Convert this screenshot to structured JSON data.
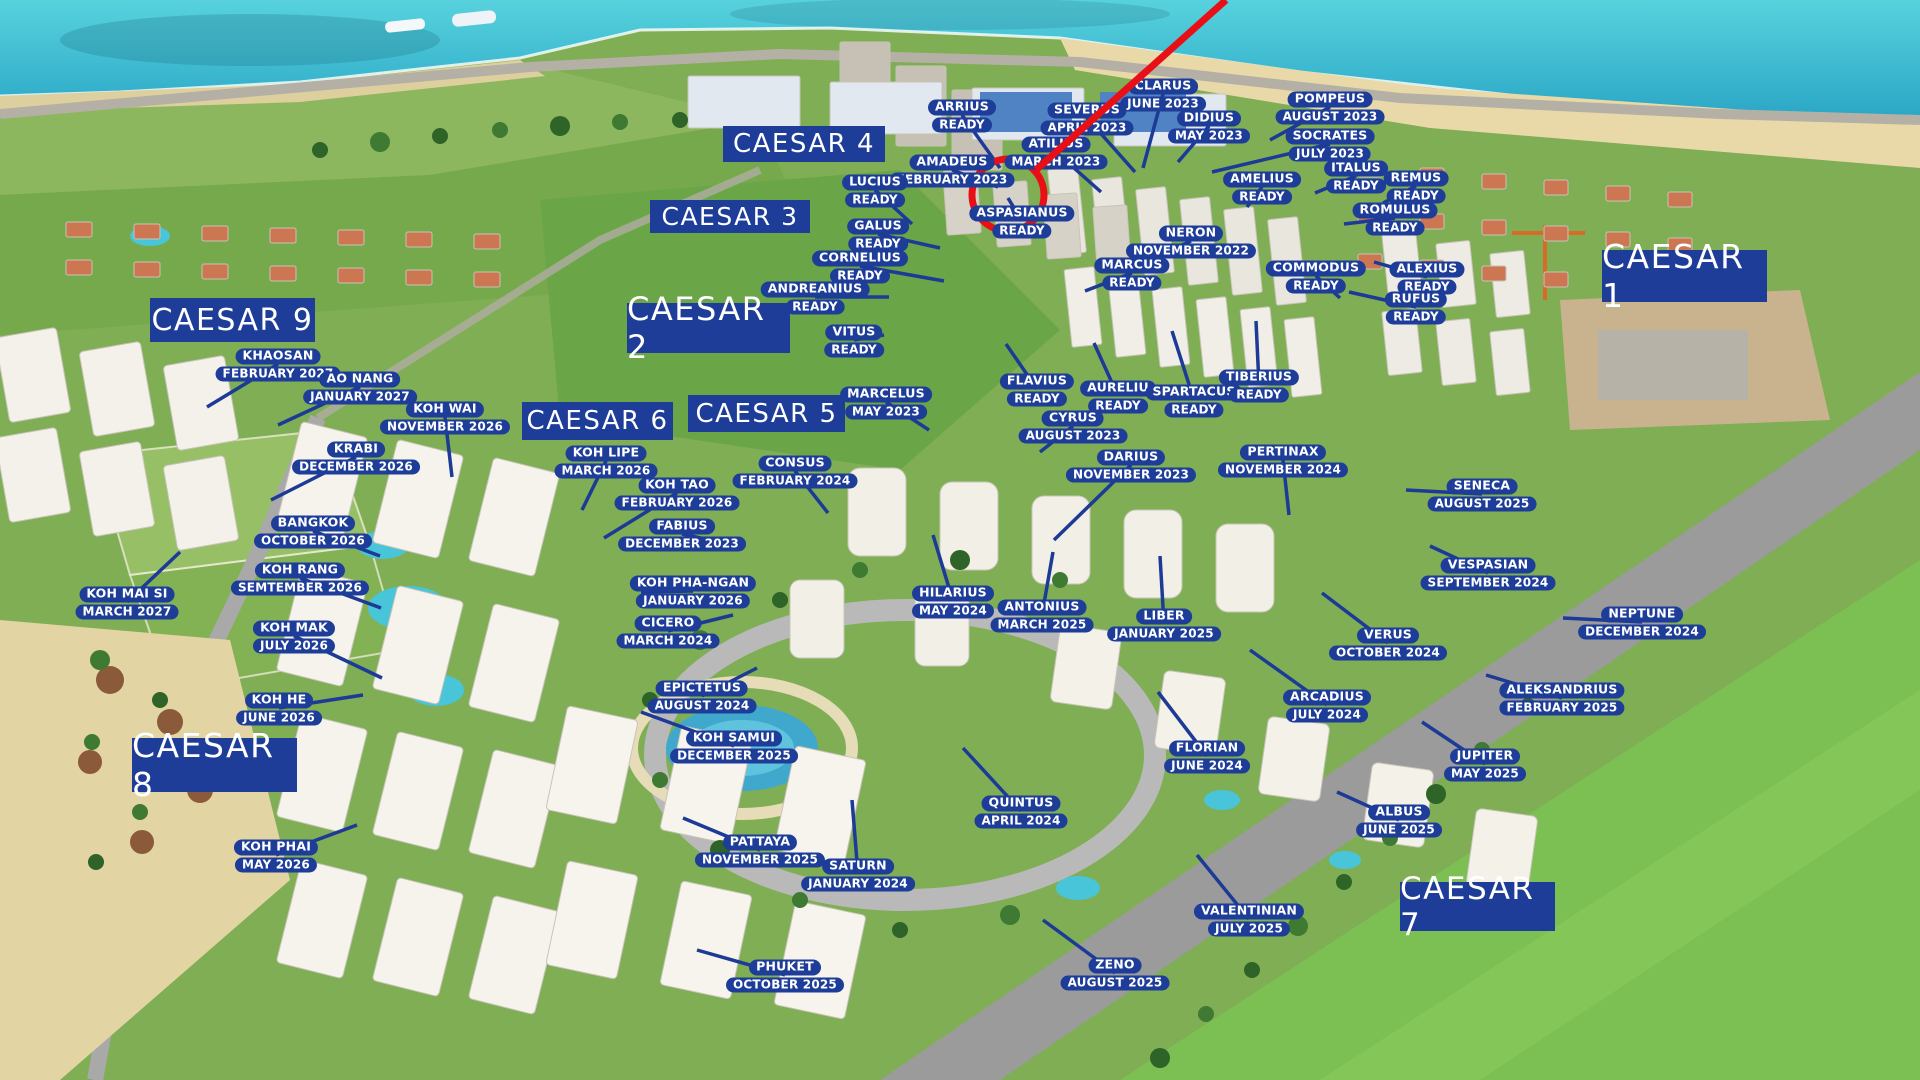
{
  "colors": {
    "label_bg": "#1d3d99",
    "label_text": "#ffffff",
    "leader_line": "#1c3a96",
    "highlight_red": "#e81016",
    "sea": "#3cc0d4",
    "sand": "#e9d9a8",
    "field_green": "#7fae55",
    "golf_green": "#7cbf52",
    "road_gray": "#9b9b9b",
    "building_white": "#f2efe7"
  },
  "highlight": {
    "circle": {
      "x": 1008,
      "y": 195,
      "r": 36
    },
    "line": {
      "x1": 1036,
      "y1": 170,
      "x2": 1226,
      "y2": 0
    }
  },
  "zones": [
    {
      "label": "CAESAR 1",
      "x": 1602,
      "y": 250,
      "w": 165,
      "h": 52,
      "fs": 33
    },
    {
      "label": "CAESAR 2",
      "x": 627,
      "y": 303,
      "w": 163,
      "h": 50,
      "fs": 32
    },
    {
      "label": "CAESAR 3",
      "x": 650,
      "y": 200,
      "w": 160,
      "h": 33,
      "fs": 25
    },
    {
      "label": "CAESAR 4",
      "x": 723,
      "y": 126,
      "w": 162,
      "h": 36,
      "fs": 26
    },
    {
      "label": "CAESAR 5",
      "x": 688,
      "y": 395,
      "w": 157,
      "h": 37,
      "fs": 26
    },
    {
      "label": "CAESAR 6",
      "x": 522,
      "y": 402,
      "w": 151,
      "h": 38,
      "fs": 26
    },
    {
      "label": "CAESAR 7",
      "x": 1400,
      "y": 882,
      "w": 155,
      "h": 49,
      "fs": 31
    },
    {
      "label": "CAESAR 8",
      "x": 132,
      "y": 738,
      "w": 165,
      "h": 54,
      "fs": 33
    },
    {
      "label": "CAESAR 9",
      "x": 150,
      "y": 298,
      "w": 165,
      "h": 44,
      "fs": 30
    }
  ],
  "buildings": [
    {
      "name": "ARRIUS",
      "date": "READY",
      "x": 962,
      "y": 115,
      "tx": 1000,
      "ty": 168
    },
    {
      "name": "CLARUS",
      "date": "JUNE 2023",
      "x": 1163,
      "y": 94,
      "tx": 1143,
      "ty": 168
    },
    {
      "name": "SEVERUS",
      "date": "APRIL 2023",
      "x": 1087,
      "y": 118,
      "tx": 1135,
      "ty": 172
    },
    {
      "name": "POMPEUS",
      "date": "AUGUST 2023",
      "x": 1330,
      "y": 107,
      "tx": 1270,
      "ty": 140
    },
    {
      "name": "DIDIUS",
      "date": "MAY 2023",
      "x": 1209,
      "y": 126,
      "tx": 1178,
      "ty": 162
    },
    {
      "name": "SOCRATES",
      "date": "JULY 2023",
      "x": 1330,
      "y": 144,
      "tx": 1212,
      "ty": 172
    },
    {
      "name": "AMADEUS",
      "date": "FEBRUARY 2023",
      "x": 952,
      "y": 170,
      "tx": 998,
      "ty": 187
    },
    {
      "name": "ATILIUS",
      "date": "MARCH 2023",
      "x": 1056,
      "y": 152,
      "tx": 1101,
      "ty": 192
    },
    {
      "name": "AMELIUS",
      "date": "READY",
      "x": 1262,
      "y": 187,
      "tx": 1247,
      "ty": 207
    },
    {
      "name": "ITALUS",
      "date": "READY",
      "x": 1356,
      "y": 176,
      "tx": 1315,
      "ty": 193
    },
    {
      "name": "REMUS",
      "date": "READY",
      "x": 1416,
      "y": 186,
      "tx": 1383,
      "ty": 203
    },
    {
      "name": "LUCIUS",
      "date": "READY",
      "x": 875,
      "y": 190,
      "tx": 912,
      "ty": 224
    },
    {
      "name": "ASPASIANUS",
      "date": "READY",
      "x": 1022,
      "y": 221,
      "tx": 1008,
      "ty": 198
    },
    {
      "name": "ROMULUS",
      "date": "READY",
      "x": 1395,
      "y": 218,
      "tx": 1344,
      "ty": 224
    },
    {
      "name": "GALUS",
      "date": "READY",
      "x": 878,
      "y": 234,
      "tx": 940,
      "ty": 248
    },
    {
      "name": "NERON",
      "date": "NOVEMBER  2022",
      "x": 1191,
      "y": 241,
      "tx": 1148,
      "ty": 260
    },
    {
      "name": "CORNELIUS",
      "date": "READY",
      "x": 860,
      "y": 266,
      "tx": 944,
      "ty": 281
    },
    {
      "name": "MARCUS",
      "date": "READY",
      "x": 1132,
      "y": 273,
      "tx": 1085,
      "ty": 291
    },
    {
      "name": "COMMODUS",
      "date": "READY",
      "x": 1316,
      "y": 276,
      "tx": 1340,
      "ty": 298
    },
    {
      "name": "ALEXIUS",
      "date": "READY",
      "x": 1427,
      "y": 277,
      "tx": 1374,
      "ty": 262
    },
    {
      "name": "ANDREANIUS",
      "date": "READY",
      "x": 815,
      "y": 297,
      "tx": 889,
      "ty": 297
    },
    {
      "name": "RUFUS",
      "date": "READY",
      "x": 1416,
      "y": 307,
      "tx": 1349,
      "ty": 292
    },
    {
      "name": "VITUS",
      "date": "READY",
      "x": 854,
      "y": 340,
      "tx": 884,
      "ty": 335
    },
    {
      "name": "FLAVIUS",
      "date": "READY",
      "x": 1037,
      "y": 389,
      "tx": 1006,
      "ty": 344
    },
    {
      "name": "AURELIU",
      "date": "READY",
      "x": 1118,
      "y": 396,
      "tx": 1094,
      "ty": 343
    },
    {
      "name": "SPARTACUS",
      "date": "READY",
      "x": 1194,
      "y": 400,
      "tx": 1172,
      "ty": 331
    },
    {
      "name": "TIBERIUS",
      "date": "READY",
      "x": 1259,
      "y": 385,
      "tx": 1256,
      "ty": 321
    },
    {
      "name": "MARCELUS",
      "date": "MAY 2023",
      "x": 886,
      "y": 402,
      "tx": 929,
      "ty": 430
    },
    {
      "name": "CYRUS",
      "date": "AUGUST 2023",
      "x": 1073,
      "y": 426,
      "tx": 1040,
      "ty": 452
    },
    {
      "name": "DARIUS",
      "date": "NOVEMBER 2023",
      "x": 1131,
      "y": 465,
      "tx": 1054,
      "ty": 540
    },
    {
      "name": "PERTINAX",
      "date": "NOVEMBER 2024",
      "x": 1283,
      "y": 460,
      "tx": 1289,
      "ty": 515
    },
    {
      "name": "SENECA",
      "date": "AUGUST 2025",
      "x": 1482,
      "y": 494,
      "tx": 1406,
      "ty": 490
    },
    {
      "name": "KHAOSAN",
      "date": "FEBRUARY 2027",
      "x": 278,
      "y": 364,
      "tx": 207,
      "ty": 407
    },
    {
      "name": "AO NANG",
      "date": "JANUARY 2027",
      "x": 360,
      "y": 387,
      "tx": 278,
      "ty": 425
    },
    {
      "name": "KOH WAI",
      "date": "NOVEMBER 2026",
      "x": 445,
      "y": 417,
      "tx": 452,
      "ty": 477
    },
    {
      "name": "KRABI",
      "date": "DECEMBER 2026",
      "x": 356,
      "y": 457,
      "tx": 271,
      "ty": 500
    },
    {
      "name": "BANGKOK",
      "date": "OCTOBER 2026",
      "x": 313,
      "y": 531,
      "tx": 380,
      "ty": 556
    },
    {
      "name": "KOH RANG",
      "date": "SEMTEMBER 2026",
      "x": 300,
      "y": 578,
      "tx": 381,
      "ty": 608
    },
    {
      "name": "KOH MAI SI",
      "date": "MARCH 2027",
      "x": 127,
      "y": 602,
      "tx": 180,
      "ty": 552
    },
    {
      "name": "KOH MAK",
      "date": "JULY 2026",
      "x": 294,
      "y": 636,
      "tx": 382,
      "ty": 678
    },
    {
      "name": "KOH HE",
      "date": "JUNE 2026",
      "x": 279,
      "y": 708,
      "tx": 363,
      "ty": 695
    },
    {
      "name": "KOH PHAI",
      "date": "MAY 2026",
      "x": 276,
      "y": 855,
      "tx": 357,
      "ty": 825
    },
    {
      "name": "KOH LIPE",
      "date": "MARCH 2026",
      "x": 606,
      "y": 461,
      "tx": 582,
      "ty": 510
    },
    {
      "name": "KOH TAO",
      "date": "FEBRUARY  2026",
      "x": 677,
      "y": 493,
      "tx": 604,
      "ty": 538
    },
    {
      "name": "FABIUS",
      "date": "DECEMBER 2023",
      "x": 682,
      "y": 534,
      "tx": 733,
      "ty": 545
    },
    {
      "name": "CONSUS",
      "date": "FEBRUARY 2024",
      "x": 795,
      "y": 471,
      "tx": 828,
      "ty": 513
    },
    {
      "name": "KOH PHA-NGAN",
      "date": "JANUARY 2026",
      "x": 693,
      "y": 591,
      "tx": 641,
      "ty": 592
    },
    {
      "name": "CICERO",
      "date": "MARCH 2024",
      "x": 668,
      "y": 631,
      "tx": 733,
      "ty": 615
    },
    {
      "name": "HILARIUS",
      "date": "MAY 2024",
      "x": 953,
      "y": 601,
      "tx": 933,
      "ty": 535
    },
    {
      "name": "ANTONIUS",
      "date": "MARCH 2025",
      "x": 1042,
      "y": 615,
      "tx": 1053,
      "ty": 552
    },
    {
      "name": "EPICTETUS",
      "date": "AUGUST 2024",
      "x": 702,
      "y": 696,
      "tx": 757,
      "ty": 668
    },
    {
      "name": "KOH SAMUI",
      "date": "DECEMBER 2025",
      "x": 734,
      "y": 746,
      "tx": 641,
      "ty": 712
    },
    {
      "name": "LIBER",
      "date": "JANUARY 2025",
      "x": 1164,
      "y": 624,
      "tx": 1160,
      "ty": 556
    },
    {
      "name": "VESPASIAN",
      "date": "SEPTEMBER 2024",
      "x": 1488,
      "y": 573,
      "tx": 1430,
      "ty": 546
    },
    {
      "name": "NEPTUNE",
      "date": "DECEMBER 2024",
      "x": 1642,
      "y": 622,
      "tx": 1563,
      "ty": 618
    },
    {
      "name": "VERUS",
      "date": "OCTOBER 2024",
      "x": 1388,
      "y": 643,
      "tx": 1322,
      "ty": 593
    },
    {
      "name": "ARCADIUS",
      "date": "JULY 2024",
      "x": 1327,
      "y": 705,
      "tx": 1250,
      "ty": 650
    },
    {
      "name": "ALEKSANDRIUS",
      "date": "FEBRUARY 2025",
      "x": 1562,
      "y": 698,
      "tx": 1486,
      "ty": 675
    },
    {
      "name": "FLORIAN",
      "date": "JUNE 2024",
      "x": 1207,
      "y": 756,
      "tx": 1158,
      "ty": 692
    },
    {
      "name": "JUPITER",
      "date": "MAY 2025",
      "x": 1485,
      "y": 764,
      "tx": 1422,
      "ty": 722
    },
    {
      "name": "ALBUS",
      "date": "JUNE 2025",
      "x": 1399,
      "y": 820,
      "tx": 1337,
      "ty": 792
    },
    {
      "name": "QUINTUS",
      "date": "APRIL 2024",
      "x": 1021,
      "y": 811,
      "tx": 963,
      "ty": 748
    },
    {
      "name": "PATTAYA",
      "date": "NOVEMBER 2025",
      "x": 760,
      "y": 850,
      "tx": 683,
      "ty": 818
    },
    {
      "name": "SATURN",
      "date": "JANUARY 2024",
      "x": 858,
      "y": 874,
      "tx": 852,
      "ty": 800
    },
    {
      "name": "VALENTINIAN",
      "date": "JULY 2025",
      "x": 1249,
      "y": 919,
      "tx": 1197,
      "ty": 855
    },
    {
      "name": "ZENO",
      "date": "AUGUST 2025",
      "x": 1115,
      "y": 973,
      "tx": 1043,
      "ty": 920
    },
    {
      "name": "PHUKET",
      "date": "OCTOBER 2025",
      "x": 785,
      "y": 975,
      "tx": 697,
      "ty": 950
    }
  ]
}
